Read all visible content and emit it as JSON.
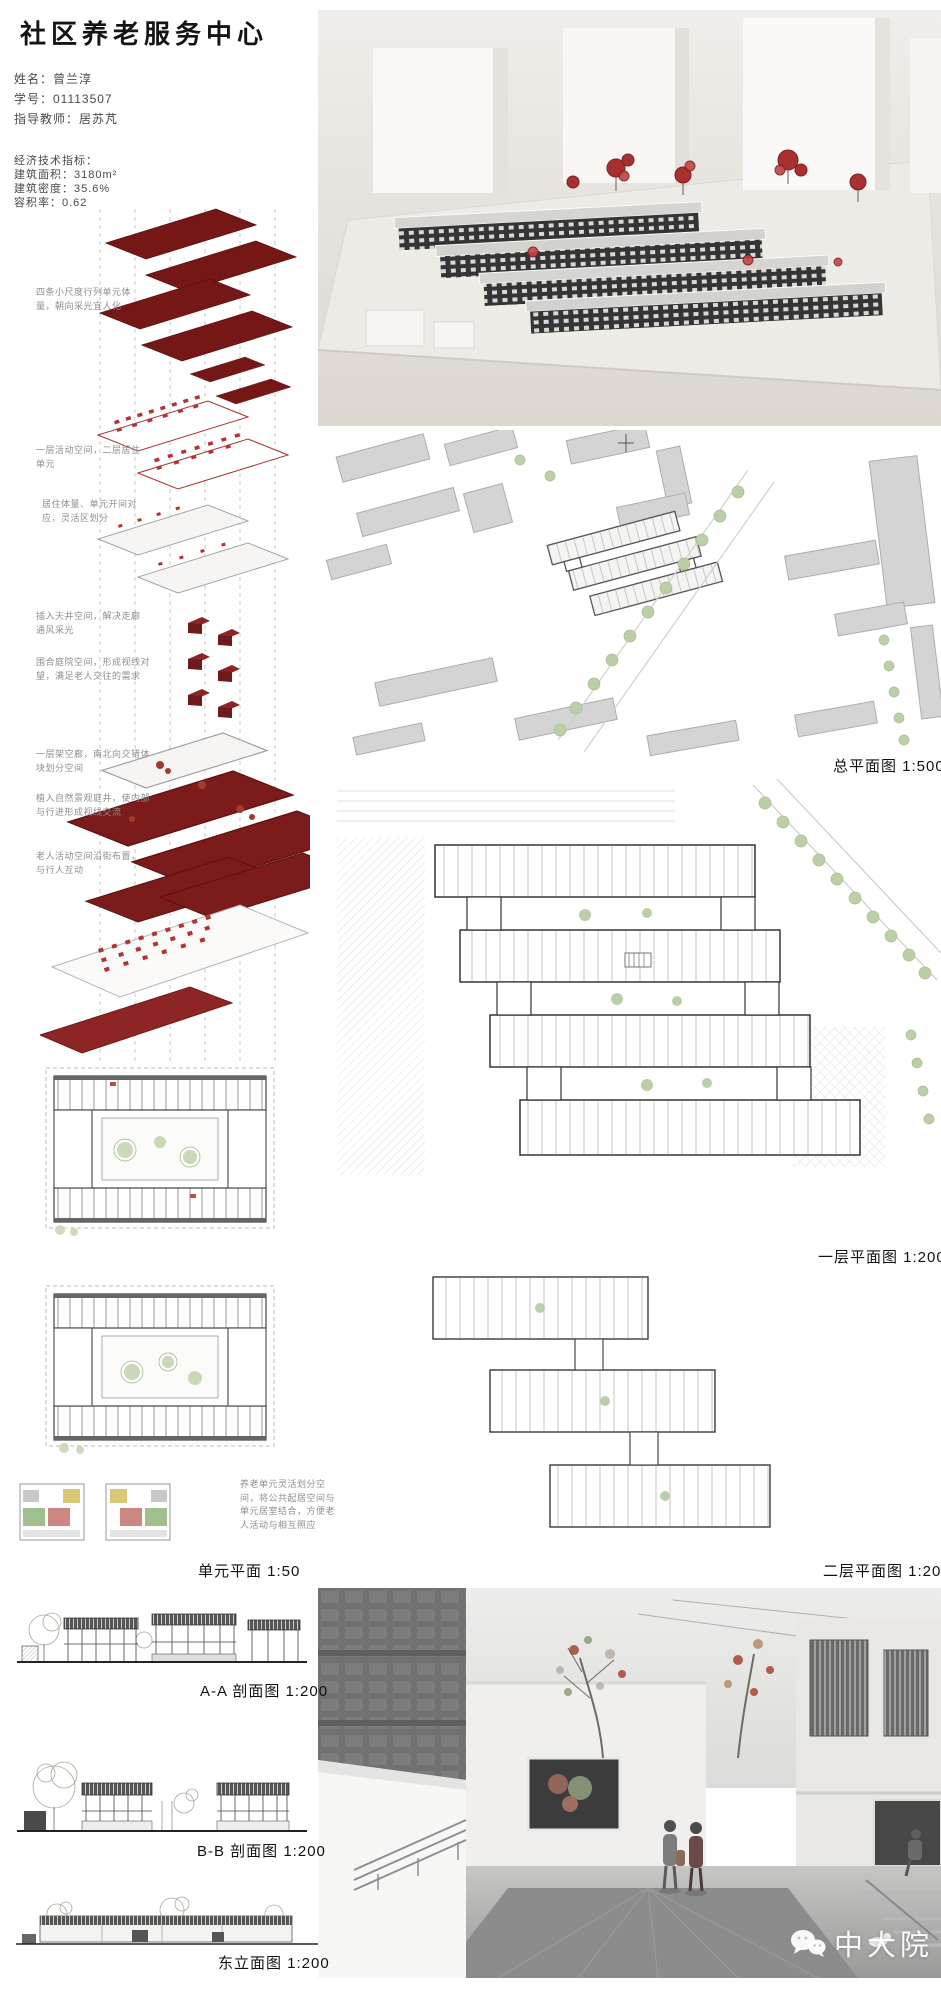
{
  "header": {
    "title": "社区养老服务中心",
    "info": {
      "name": "姓名：曾兰淳",
      "student_id": "学号：01113507",
      "advisor": "指导教师：居苏芃"
    },
    "indicators": {
      "heading": "经济技术指标：",
      "floor_area": "建筑面积：3180m²",
      "density": "建筑密度：35.6%",
      "far": "容积率：0.62"
    }
  },
  "axon": {
    "annotations": [
      "四条小尺度行列单元体量，朝向采光宜人化",
      "一层活动空间，二层居住单元",
      "居住体量、单元开间对应，灵活区划分",
      "插入天井空间，解决走廊通风采光",
      "围合庭院空间，形成视线对望，满足老人交往的需求",
      "一层架空廊，南北向交错体块划分空间",
      "植入自然景观庭井，使内部与行进形成视线交流",
      "老人活动空间沿街布置，与行人互动"
    ]
  },
  "drawings": {
    "site_plan_label": "总平面图 1:500",
    "floor1_label": "一层平面图 1:200",
    "unit_label": "单元平面 1:50",
    "unit_note": "养老单元灵活划分空间，将公共起居空间与单元居室结合，方便老人活动与相互照应",
    "floor2_label": "二层平面图 1:200",
    "section_aa_label": "A-A 剖面图 1:200",
    "section_bb_label": "B-B 剖面图 1:200",
    "elevation_label": "东立面图 1:200"
  },
  "watermark": {
    "logo": "中大院",
    "icon": "wechat-icon"
  },
  "colors": {
    "accent_red": "#7c1b1b",
    "furniture_red": "#b03434",
    "tree_green": "#b5c9a0",
    "watermark_white": "#ffffff"
  }
}
